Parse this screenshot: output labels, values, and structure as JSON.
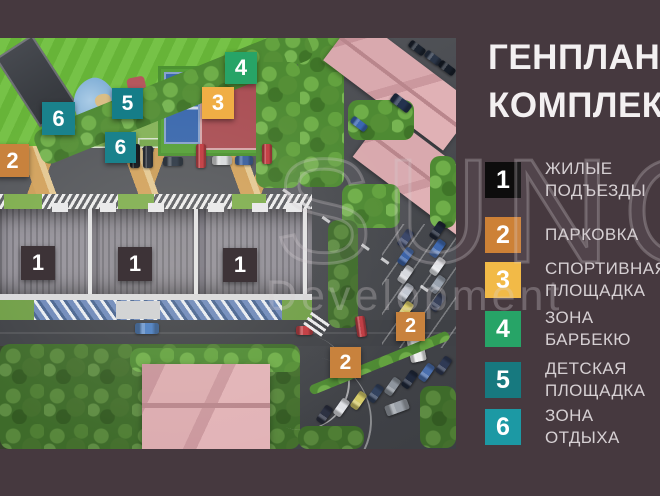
{
  "title": {
    "line1": "ГЕНПЛАН",
    "line2": "КОМПЛЕКСА"
  },
  "watermark": {
    "line1": "SUNCIT",
    "line2": "Development"
  },
  "legend": {
    "items": [
      {
        "number": "1",
        "label": "ЖИЛЫЕ ПОДЪЕЗДЫ",
        "color": "#0d0c0c"
      },
      {
        "number": "2",
        "label": "ПАРКОВКА",
        "color": "#cd8136"
      },
      {
        "number": "3",
        "label": "СПОРТИВНАЯ\nПЛОЩАДКА",
        "color": "#f2ba47"
      },
      {
        "number": "4",
        "label": "ЗОНА БАРБЕКЮ",
        "color": "#27a467"
      },
      {
        "number": "5",
        "label": "ДЕТСКАЯ\nПЛОЩАДКА",
        "color": "#17797f"
      },
      {
        "number": "6",
        "label": "ЗОНА ОТДЫХА",
        "color": "#1c99a4"
      }
    ]
  },
  "map": {
    "markers": [
      {
        "label": "2",
        "color": "#c8823d"
      },
      {
        "label": "6",
        "color": "#1a828c"
      },
      {
        "label": "5",
        "color": "#157d88"
      },
      {
        "label": "6",
        "color": "#1a828c"
      },
      {
        "label": "4",
        "color": "#27a467"
      },
      {
        "label": "3",
        "color": "#f0ae45"
      },
      {
        "label": "1",
        "color": "#3d3337"
      },
      {
        "label": "1",
        "color": "#3d3337"
      },
      {
        "label": "1",
        "color": "#3d3337"
      },
      {
        "label": "2",
        "color": "#c8823d"
      },
      {
        "label": "2",
        "color": "#c8823d"
      }
    ]
  }
}
